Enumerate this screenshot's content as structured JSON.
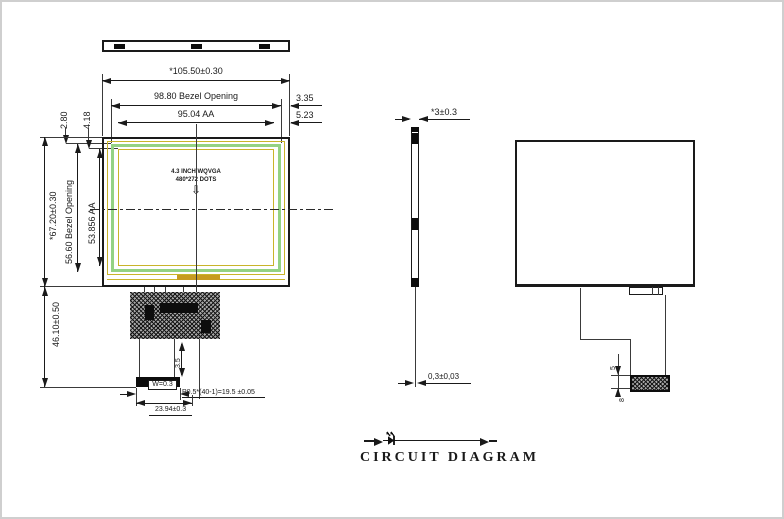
{
  "canvas": {
    "background": "#ffffff",
    "frame_color": "#cfcfcf",
    "ink_color": "#1a1a1a",
    "bezel_line_green": "#94d283",
    "aa_line_yellow": "#c9b42a",
    "tape_gold": "#c79b20"
  },
  "front": {
    "dims": {
      "overall_width": "*105.50±0.30",
      "bezel_width": "98.80 Bezel Opening",
      "aa_width": "95.04 AA",
      "edge_gap_bezel": "3.35",
      "edge_gap_aa": "5.23",
      "top_gap_bezel": "2.80",
      "top_gap_aa": "4.18",
      "overall_height": "*67.20±0.30",
      "bezel_height": "56.60 Bezel Opening",
      "aa_height": "53.856 AA",
      "fpc_drop": "46.10±0.50",
      "tail_len": "3.5",
      "contact_width": "W=0.3",
      "pin_pitch": "P0.5*(40-1)=19.5 ±0.05",
      "tail_width": "23.94±0.3"
    },
    "screen_label": {
      "line1": "4.3 INCH WQVGA",
      "line2": "480*272 DOTS"
    },
    "down_arrow": "⇩"
  },
  "side": {
    "dims": {
      "thickness": "*3±0.3",
      "fpc_thickness": "0,3±0,03"
    }
  },
  "rear": {
    "dims": {
      "fold_gap": "5",
      "connector": "8"
    }
  },
  "circuit": {
    "title": "CIRCUIT DIAGRAM",
    "led_count": 8
  }
}
